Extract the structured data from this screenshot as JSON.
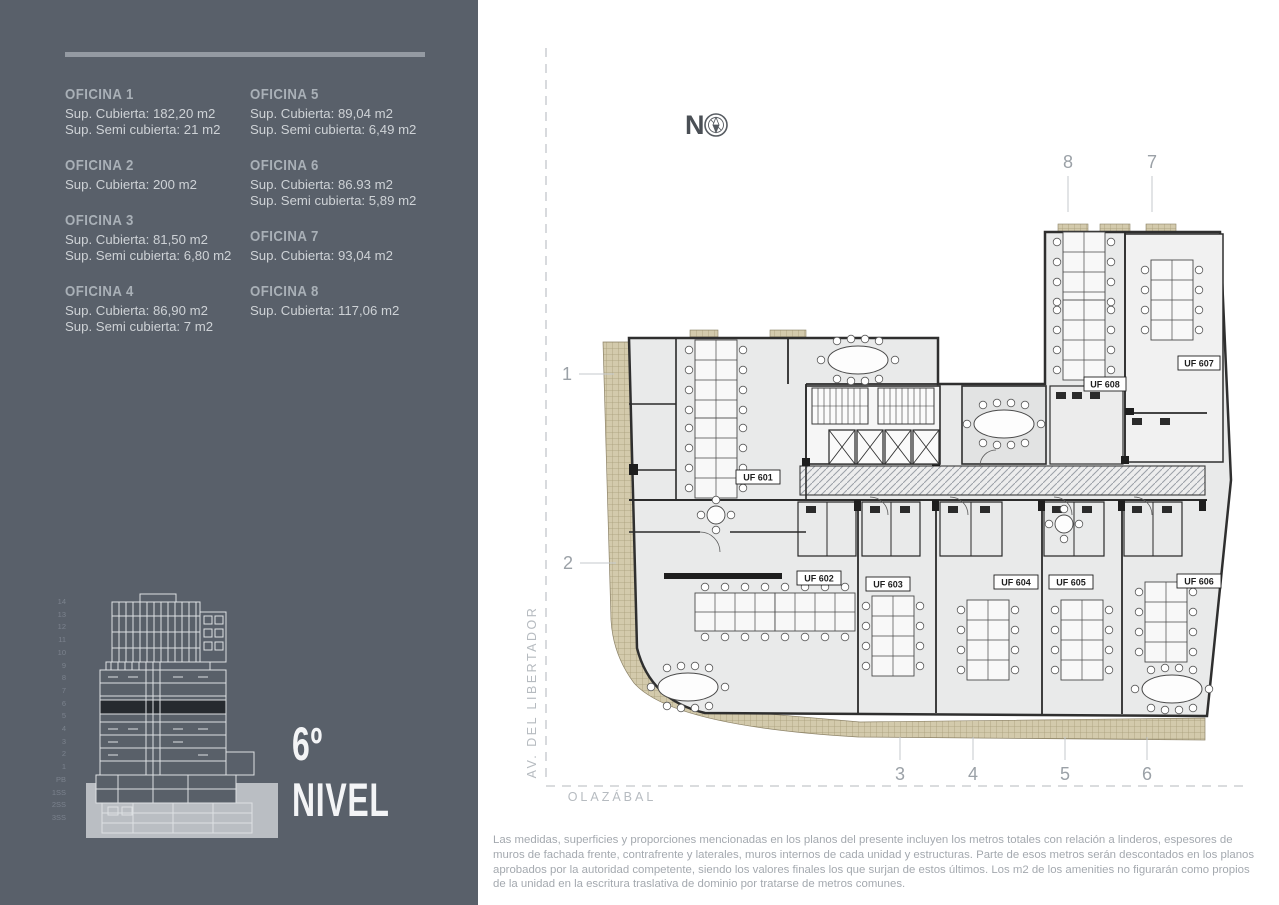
{
  "sidebar": {
    "offices": [
      {
        "name": "OFICINA 1",
        "line1": "Sup. Cubierta: 182,20 m2",
        "line2": "Sup. Semi cubierta: 21 m2"
      },
      {
        "name": "OFICINA 2",
        "line1": "Sup. Cubierta: 200 m2",
        "line2": ""
      },
      {
        "name": "OFICINA 3",
        "line1": "Sup. Cubierta: 81,50 m2",
        "line2": "Sup. Semi cubierta: 6,80 m2"
      },
      {
        "name": "OFICINA 4",
        "line1": "Sup. Cubierta: 86,90 m2",
        "line2": "Sup. Semi cubierta: 7 m2"
      },
      {
        "name": "OFICINA 5",
        "line1": "Sup. Cubierta: 89,04 m2",
        "line2": "Sup. Semi cubierta: 6,49 m2"
      },
      {
        "name": "OFICINA 6",
        "line1": "Sup. Cubierta: 86.93 m2",
        "line2": "Sup. Semi cubierta: 5,89 m2"
      },
      {
        "name": "OFICINA 7",
        "line1": "Sup. Cubierta: 93,04 m2",
        "line2": ""
      },
      {
        "name": "OFICINA 8",
        "line1": "Sup. Cubierta: 117,06 m2",
        "line2": ""
      }
    ],
    "elevation_floors": [
      "14",
      "13",
      "12",
      "11",
      "10",
      "9",
      "8",
      "7",
      "6",
      "5",
      "4",
      "3",
      "2",
      "1",
      "PB",
      "1SS",
      "2SS",
      "3SS"
    ],
    "level_title": {
      "line1": "6º",
      "line2": "NIVEL"
    }
  },
  "plan": {
    "north_label": "N",
    "streets": {
      "left": "AV. DEL LIBERTADOR",
      "bottom": "OLAZÁBAL"
    },
    "grid": {
      "top": [
        "8",
        "7"
      ],
      "left": [
        "1",
        "2"
      ],
      "bottom": [
        "3",
        "4",
        "5",
        "6"
      ]
    },
    "units": [
      "UF 601",
      "UF 602",
      "UF 603",
      "UF 604",
      "UF 605",
      "UF 606",
      "UF 607",
      "UF 608"
    ]
  },
  "footer": {
    "disclaimer": "Las medidas, superficies y proporciones mencionadas en los planos del presente incluyen los metros totales con relación a linderos, espesores de muros de fachada frente, contrafrente y laterales, muros internos de cada unidad y estructuras. Parte de esos metros serán descontados en los planos aprobados por la autoridad competente, siendo los valores finales los que surjan de estos últimos.  Los m2 de los amenities no figurarán como propios de la unidad en la escritura traslativa de dominio por tratarse de metros comunes."
  },
  "colors": {
    "sidebar_bg": "#59606a",
    "level_highlight": "#22262b",
    "balcony_beige": "#d2c9ab",
    "wall": "#2f2f2f",
    "grid_text": "#9ba1a7",
    "street_text": "#b6bbc0"
  }
}
